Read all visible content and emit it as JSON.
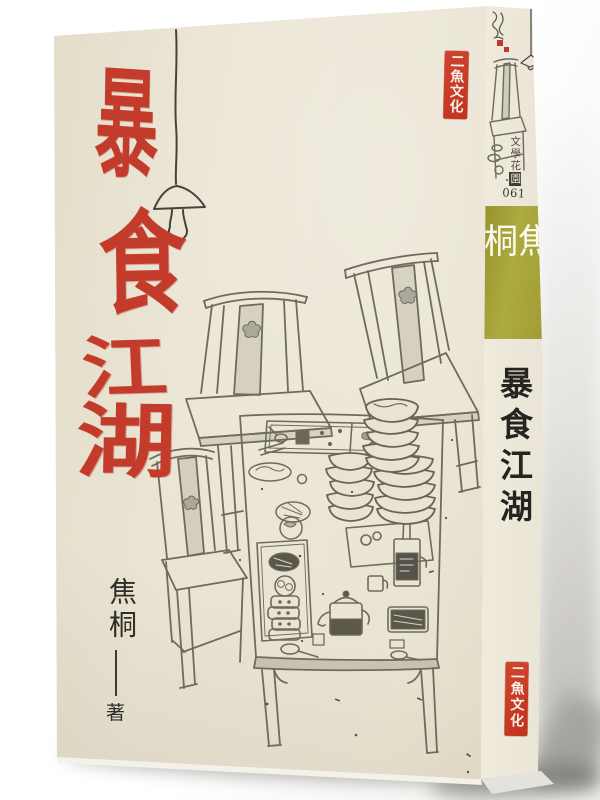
{
  "book": {
    "front_cover": {
      "title_characters": [
        "暴",
        "食",
        "江",
        "湖"
      ],
      "author_name": "焦桐",
      "author_role": "著",
      "publisher_logo_text": "二魚文化"
    },
    "spine": {
      "series_name_prefix": "文學花",
      "series_name_boxed": "園",
      "series_number": "061",
      "author_name": "焦桐",
      "title": "暴食江湖",
      "publisher_logo_text": "二魚文化"
    },
    "colors": {
      "title_red": "#c33b2b",
      "seal_red": "#c83a28",
      "author_block_olive": "#a6a339",
      "cover_cream": "#e9e3d1",
      "illustration_ink": "#6e6b5d"
    },
    "illustration_elements": [
      "hanging-lamp-icon",
      "ming-chair",
      "dining-table",
      "stacked-bowls",
      "teapot",
      "wine-bottle-tray",
      "cups-stack",
      "food-plates",
      "artist-signature",
      "seal-stamp"
    ]
  }
}
